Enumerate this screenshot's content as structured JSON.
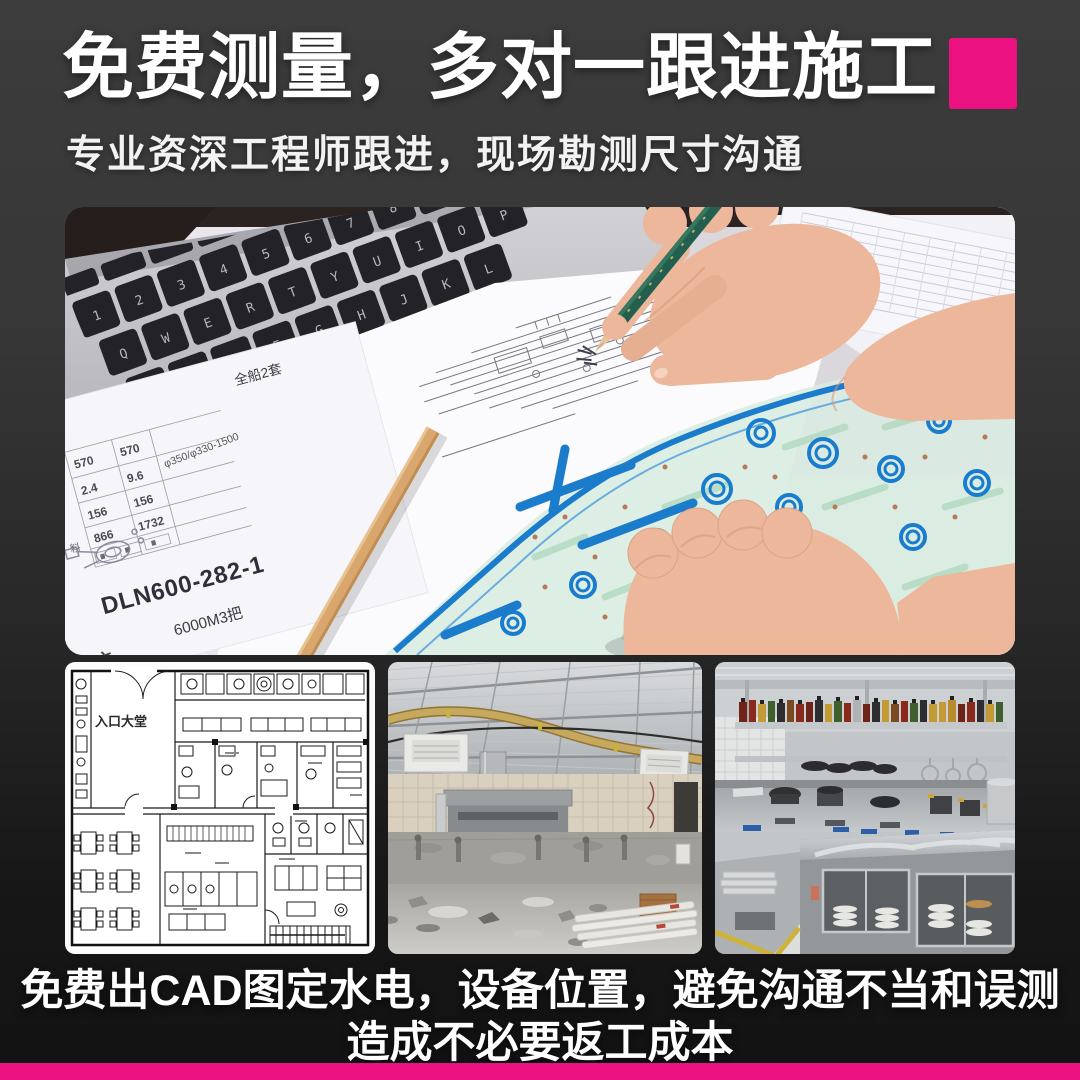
{
  "theme": {
    "bg_top": "#3b3b3b",
    "bg_bottom": "#141414",
    "accent": "#ec1180",
    "text": "#ffffff"
  },
  "header": {
    "title": "免费测量，多对一跟进施工",
    "subtitle": "专业资深工程师跟进，现场勘测尺寸沟通"
  },
  "hero": {
    "keyboard_rows": [
      "1234567890",
      "QWERTYUIOP",
      "ASDFGHJKL",
      "ZXCVBNM"
    ],
    "spec_table": {
      "corner_label": "全船2套",
      "rows": [
        [
          "570",
          "570"
        ],
        [
          "2.4",
          "9.6"
        ],
        [
          "156",
          "156"
        ],
        [
          "866",
          "1732"
        ]
      ],
      "spec": "φ350/φ330-1500",
      "material_label": "料",
      "code": "DLN600-282-1",
      "subcode": "6000M3把",
      "handwritten": "系统",
      "watermark": "OF"
    }
  },
  "gallery": {
    "items": [
      {
        "name": "cad-floorplan",
        "label": "入口大堂"
      },
      {
        "name": "construction-site",
        "label": ""
      },
      {
        "name": "finished-kitchen",
        "label": ""
      }
    ]
  },
  "caption": {
    "line1": "免费出CAD图定水电，设备位置，避免沟通不当和误测",
    "line2": "造成不必要返工成本"
  }
}
